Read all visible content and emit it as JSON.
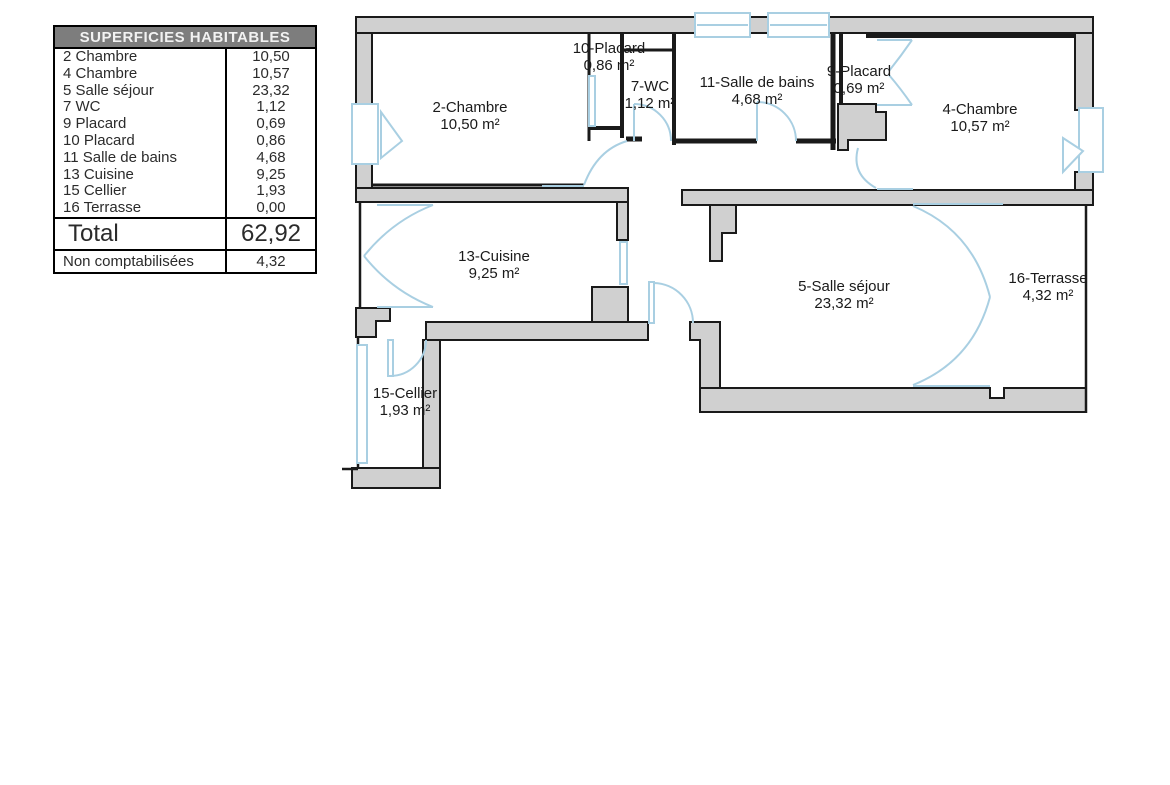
{
  "table": {
    "title": "SUPERFICIES HABITABLES",
    "rows": [
      {
        "label": "2 Chambre",
        "value": "10,50"
      },
      {
        "label": "4 Chambre",
        "value": "10,57"
      },
      {
        "label": "5 Salle séjour",
        "value": "23,32"
      },
      {
        "label": "7 WC",
        "value": "1,12"
      },
      {
        "label": "9 Placard",
        "value": "0,69"
      },
      {
        "label": "10 Placard",
        "value": "0,86"
      },
      {
        "label": "11 Salle de bains",
        "value": "4,68"
      },
      {
        "label": "13 Cuisine",
        "value": "9,25"
      },
      {
        "label": "15 Cellier",
        "value": "1,93"
      },
      {
        "label": "16 Terrasse",
        "value": "0,00"
      }
    ],
    "total_label": "Total",
    "total_value": "62,92",
    "footer_label": "Non comptabilisées",
    "footer_value": "4,32"
  },
  "floorplan": {
    "rooms": [
      {
        "id": "2",
        "name": "2-Chambre",
        "area": "10,50 m²"
      },
      {
        "id": "10",
        "name": "10-Placard",
        "area": "0,86 m²"
      },
      {
        "id": "7",
        "name": "7-WC",
        "area": "1,12 m²"
      },
      {
        "id": "11",
        "name": "11-Salle de bains",
        "area": "4,68 m²"
      },
      {
        "id": "9",
        "name": "9-Placard",
        "area": "0,69 m²"
      },
      {
        "id": "4",
        "name": "4-Chambre",
        "area": "10,57 m²"
      },
      {
        "id": "13",
        "name": "13-Cuisine",
        "area": "9,25 m²"
      },
      {
        "id": "5",
        "name": "5-Salle séjour",
        "area": "23,32 m²"
      },
      {
        "id": "16",
        "name": "16-Terrasse",
        "area": "4,32 m²"
      },
      {
        "id": "15",
        "name": "15-Cellier",
        "area": "1,93 m²"
      }
    ],
    "colors": {
      "wall_fill": "#d0d0d0",
      "wall_stroke": "#1a1a1a",
      "feature_blue": "#a9cfe2",
      "table_header_bg": "#7d7d7d"
    }
  }
}
